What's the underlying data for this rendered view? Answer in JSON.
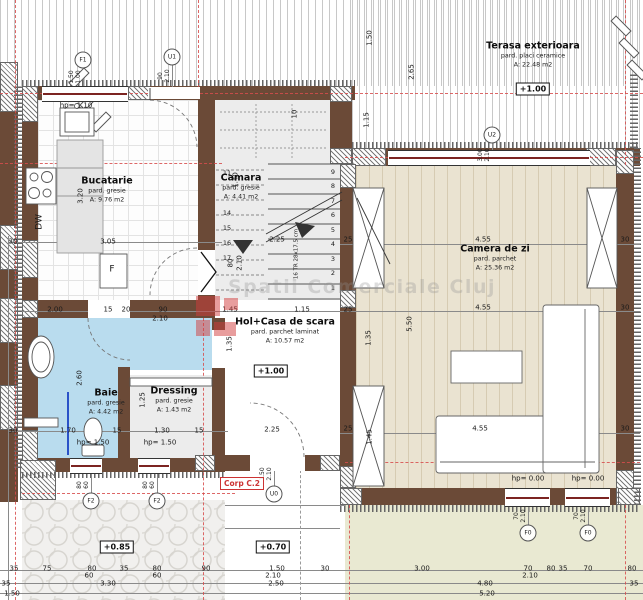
{
  "plan": {
    "corp_label": "Corp C.2",
    "watermark": {
      "text": "Spatii Comerciale Cluj"
    },
    "rooms": [
      {
        "id": "bucatarie",
        "name": "Bucatarie",
        "floor": "pard. gresie",
        "area": "A: 9.76 m2",
        "cx": 107,
        "cy": 190
      },
      {
        "id": "camara",
        "name": "Camara",
        "floor": "pard. gresie",
        "area": "A: 4.41 m2",
        "cx": 241,
        "cy": 187
      },
      {
        "id": "hol-casa-de-scara",
        "name": "Hol+Casa de scara",
        "floor": "pard. parchet laminat",
        "area": "A: 10.57 m2",
        "cx": 285,
        "cy": 331
      },
      {
        "id": "baie",
        "name": "Baie",
        "floor": "pard. gresie",
        "area": "A: 4.42 m2",
        "cx": 106,
        "cy": 402
      },
      {
        "id": "dressing",
        "name": "Dressing",
        "floor": "pard. gresie",
        "area": "A: 1.43 m2",
        "cx": 174,
        "cy": 400
      },
      {
        "id": "camera-de-zi",
        "name": "Camera de zi",
        "floor": "pard. parchet",
        "area": "A: 25.36 m2",
        "cx": 495,
        "cy": 258
      },
      {
        "id": "terasa-exterioara",
        "name": "Terasa exterioara",
        "floor": "pard. placi ceramice",
        "area": "A: 22.48 m2",
        "cx": 533,
        "cy": 55
      }
    ],
    "elevations": [
      {
        "text": "+1.00",
        "x": 533,
        "y": 89
      },
      {
        "text": "+1.00",
        "x": 271,
        "y": 371
      },
      {
        "text": "+0.85",
        "x": 117,
        "y": 547
      },
      {
        "text": "+0.70",
        "x": 273,
        "y": 547
      }
    ],
    "markers": [
      {
        "id": "F1",
        "x": 83,
        "y": 60,
        "a": "1.50",
        "b": "1.00",
        "dx": 75,
        "dy": 77
      },
      {
        "id": "U1",
        "x": 172,
        "y": 57,
        "a": "90",
        "b": "2.10",
        "dx": 164,
        "dy": 76
      },
      {
        "id": "U2",
        "x": 492,
        "y": 135,
        "a": "3.00",
        "b": "2.10",
        "dx": 484,
        "dy": 155
      },
      {
        "id": "U0",
        "x": 274,
        "y": 494,
        "a": "1.50",
        "b": "2.10",
        "dx": 266,
        "dy": 474
      },
      {
        "id": "F2",
        "x": 91,
        "y": 501,
        "a": "80",
        "b": "60",
        "dx": 83,
        "dy": 485
      },
      {
        "id": "F2",
        "x": 157,
        "y": 501,
        "a": "80",
        "b": "60",
        "dx": 149,
        "dy": 485
      },
      {
        "id": "F0",
        "x": 528,
        "y": 533,
        "a": "70",
        "b": "2.10",
        "dx": 520,
        "dy": 516
      },
      {
        "id": "F0",
        "x": 588,
        "y": 533,
        "a": "70",
        "b": "2.10",
        "dx": 580,
        "dy": 516
      }
    ],
    "stair": {
      "tread_label": "16 TR 28x17.5 cm",
      "down_numbers": [
        {
          "t": "1",
          "x": 333,
          "y": 288
        },
        {
          "t": "2",
          "x": 333,
          "y": 273
        },
        {
          "t": "3",
          "x": 333,
          "y": 259
        },
        {
          "t": "4",
          "x": 333,
          "y": 244
        },
        {
          "t": "5",
          "x": 333,
          "y": 230
        },
        {
          "t": "6",
          "x": 333,
          "y": 215
        },
        {
          "t": "7",
          "x": 333,
          "y": 201
        },
        {
          "t": "8",
          "x": 333,
          "y": 186
        },
        {
          "t": "9",
          "x": 333,
          "y": 172
        }
      ],
      "up_numbers": [
        {
          "t": "11",
          "x": 227,
          "y": 173
        },
        {
          "t": "14",
          "x": 227,
          "y": 213
        },
        {
          "t": "15",
          "x": 227,
          "y": 228
        },
        {
          "t": "16",
          "x": 227,
          "y": 243
        },
        {
          "t": "17",
          "x": 227,
          "y": 258
        }
      ]
    },
    "dims": [
      {
        "t": "30",
        "x": 13,
        "y": 242
      },
      {
        "t": "3.05",
        "x": 108,
        "y": 242
      },
      {
        "t": "2.25",
        "x": 277,
        "y": 240
      },
      {
        "t": "25",
        "x": 348,
        "y": 240
      },
      {
        "t": "4.55",
        "x": 483,
        "y": 240
      },
      {
        "t": "30",
        "x": 625,
        "y": 240
      },
      {
        "t": "2.00",
        "x": 55,
        "y": 310
      },
      {
        "t": "15",
        "x": 108,
        "y": 310
      },
      {
        "t": "20",
        "x": 126,
        "y": 310
      },
      {
        "t": "90",
        "x": 163,
        "y": 310
      },
      {
        "t": "2.10",
        "x": 160,
        "y": 319
      },
      {
        "t": "1.45",
        "x": 230,
        "y": 310
      },
      {
        "t": "1.15",
        "x": 302,
        "y": 310
      },
      {
        "t": "25",
        "x": 348,
        "y": 310
      },
      {
        "t": "4.55",
        "x": 483,
        "y": 308
      },
      {
        "t": "30",
        "x": 625,
        "y": 308
      },
      {
        "t": "30",
        "x": 13,
        "y": 431
      },
      {
        "t": "1.70",
        "x": 68,
        "y": 431
      },
      {
        "t": "15",
        "x": 117,
        "y": 431
      },
      {
        "t": "1.30",
        "x": 162,
        "y": 431
      },
      {
        "t": "15",
        "x": 199,
        "y": 431
      },
      {
        "t": "2.25",
        "x": 272,
        "y": 430
      },
      {
        "t": "25",
        "x": 348,
        "y": 429
      },
      {
        "t": "4.55",
        "x": 480,
        "y": 429
      },
      {
        "t": "30",
        "x": 625,
        "y": 429
      },
      {
        "t": "35",
        "x": 14,
        "y": 569
      },
      {
        "t": "75",
        "x": 47,
        "y": 569
      },
      {
        "t": "80",
        "x": 92,
        "y": 569
      },
      {
        "t": "35",
        "x": 124,
        "y": 569
      },
      {
        "t": "80",
        "x": 157,
        "y": 569
      },
      {
        "t": "90",
        "x": 206,
        "y": 569
      },
      {
        "t": "1.50",
        "x": 277,
        "y": 569
      },
      {
        "t": "30",
        "x": 325,
        "y": 569
      },
      {
        "t": "3.00",
        "x": 422,
        "y": 569
      },
      {
        "t": "70",
        "x": 528,
        "y": 569
      },
      {
        "t": "80",
        "x": 551,
        "y": 569
      },
      {
        "t": "35",
        "x": 563,
        "y": 569
      },
      {
        "t": "70",
        "x": 588,
        "y": 569
      },
      {
        "t": "80",
        "x": 632,
        "y": 569
      },
      {
        "t": "60",
        "x": 89,
        "y": 576
      },
      {
        "t": "60",
        "x": 157,
        "y": 576
      },
      {
        "t": "2.10",
        "x": 273,
        "y": 576
      },
      {
        "t": "2.10",
        "x": 530,
        "y": 576
      },
      {
        "t": "3.30",
        "x": 108,
        "y": 584
      },
      {
        "t": "2.50",
        "x": 276,
        "y": 584
      },
      {
        "t": "4.80",
        "x": 485,
        "y": 584
      },
      {
        "t": "35",
        "x": 634,
        "y": 584
      },
      {
        "t": "35",
        "x": 6,
        "y": 584
      },
      {
        "t": "5.20",
        "x": 487,
        "y": 594
      },
      {
        "t": "1.50",
        "x": 12,
        "y": 594
      },
      {
        "t": "hp= 1.10",
        "x": 76,
        "y": 106
      },
      {
        "t": "hp= 1.50",
        "x": 93,
        "y": 443
      },
      {
        "t": "hp= 1.50",
        "x": 160,
        "y": 443
      },
      {
        "t": "hp= 0.00",
        "x": 528,
        "y": 479
      },
      {
        "t": "hp= 0.00",
        "x": 588,
        "y": 479
      },
      {
        "t": "1.50",
        "x": 370,
        "y": 38,
        "r": 1
      },
      {
        "t": "2.65",
        "x": 412,
        "y": 72,
        "r": 1
      },
      {
        "t": "1.15",
        "x": 367,
        "y": 120,
        "r": 1
      },
      {
        "t": "3.20",
        "x": 81,
        "y": 196,
        "r": 1
      },
      {
        "t": "2.60",
        "x": 80,
        "y": 378,
        "r": 1
      },
      {
        "t": "1.25",
        "x": 143,
        "y": 400,
        "r": 1
      },
      {
        "t": "5.50",
        "x": 410,
        "y": 324,
        "r": 1
      },
      {
        "t": "1.35",
        "x": 369,
        "y": 338,
        "r": 1
      },
      {
        "t": "1.45",
        "x": 370,
        "y": 437,
        "r": 1
      },
      {
        "t": "1.35",
        "x": 230,
        "y": 344,
        "r": 1
      },
      {
        "t": "10",
        "x": 295,
        "y": 114,
        "r": 1
      },
      {
        "t": "1.40",
        "x": 236,
        "y": 180,
        "r": 1
      },
      {
        "t": "80",
        "x": 231,
        "y": 263,
        "r": 1
      },
      {
        "t": "2.10",
        "x": 240,
        "y": 263,
        "r": 1
      },
      {
        "t": "16 TR 28x17.5 cm",
        "x": 297,
        "y": 254,
        "r": 1,
        "s": 5.5
      },
      {
        "t": "DW",
        "x": 40,
        "y": 222,
        "r": 1,
        "s": 9
      },
      {
        "t": "F",
        "x": 112,
        "y": 270,
        "s": 9
      }
    ]
  }
}
